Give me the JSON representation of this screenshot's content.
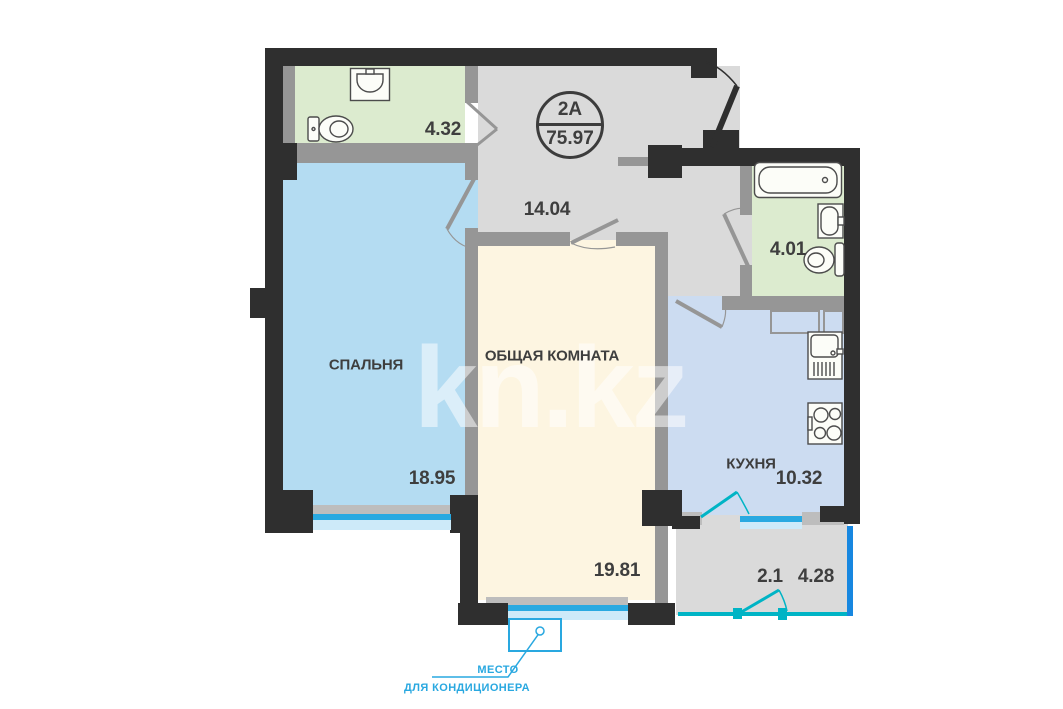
{
  "plan": {
    "badge": {
      "unit": "2А",
      "total_area": "75.97"
    },
    "rooms": {
      "wc": {
        "area": "4.32"
      },
      "hallway": {
        "area": "14.04"
      },
      "bathroom": {
        "area": "4.01"
      },
      "bedroom": {
        "name": "СПАЛЬНЯ",
        "area": "18.95"
      },
      "living": {
        "name": "ОБЩАЯ КОМНАТА",
        "area": "19.81"
      },
      "kitchen": {
        "name": "КУХНЯ",
        "area": "10.32"
      },
      "balcony": {
        "area_coefficient": "2.1",
        "area": "4.28"
      }
    },
    "ac_note": {
      "line1": "МЕСТО",
      "line2": "ДЛЯ КОНДИЦИОНЕРА"
    },
    "watermark": "kn.kz",
    "colors": {
      "wall": "#2f2f2f",
      "wall2": "#969696",
      "sill": "#bdbdbd",
      "corridor": "#dadada",
      "wet": "#dcebcf",
      "bedroom": "#b4dcf2",
      "living": "#fdf5e1",
      "kitchen": "#ccdcf1",
      "window": "#29a9e1",
      "window2": "#cdeaf9",
      "glaze": "#00b4c5",
      "balconyEdge": "#1787e0",
      "accent": "#29a8e0",
      "label": "#3e3e3e"
    }
  }
}
